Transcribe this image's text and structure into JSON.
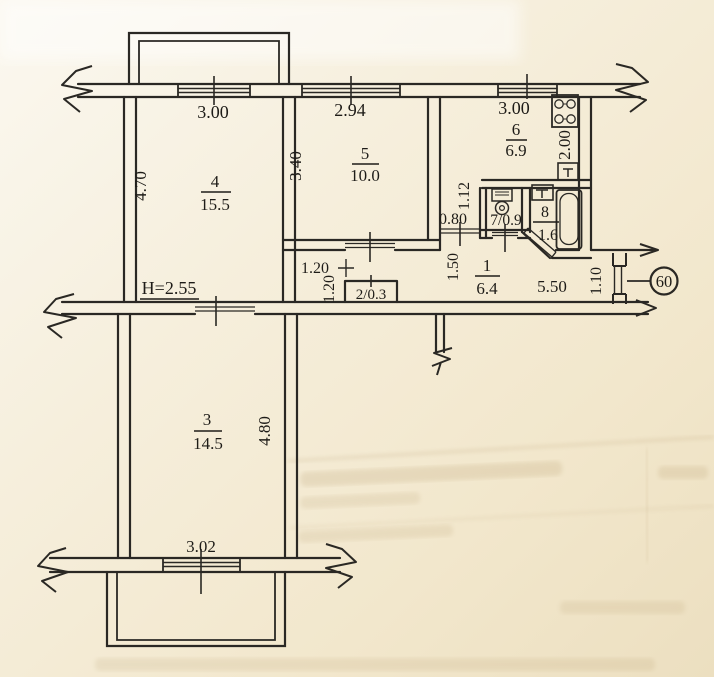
{
  "plan": {
    "height_note": "Н=2.55",
    "apartment_number": "60",
    "rooms": {
      "hall": {
        "number": "1",
        "area": "6.4"
      },
      "closet": {
        "label": "2/0.3"
      },
      "room3": {
        "number": "3",
        "area": "14.5"
      },
      "room4": {
        "number": "4",
        "area": "15.5"
      },
      "room5": {
        "number": "5",
        "area": "10.0"
      },
      "kitchen": {
        "number": "6",
        "area": "6.9"
      },
      "wc": {
        "label": "7/0.9"
      },
      "bath": {
        "number": "8",
        "area": "1.6"
      }
    },
    "dimensions": {
      "window_room4": "3.00",
      "window_room5": "2.94",
      "window_kitchen": "3.00",
      "window_room3": "3.02",
      "room4_depth": "4.70",
      "room5_depth": "3.40",
      "kitchen_depth": "2.00",
      "niche_depth": "1.12",
      "kitchen_door_width": "0.80",
      "hall_width": "1.50",
      "hall_length": "5.50",
      "entry_door_width": "1.10",
      "closet_width": "1.20",
      "closet_depth": "1.20",
      "room3_depth": "4.80"
    },
    "colors": {
      "ink": "#2a2824",
      "paper": "#f5eedb"
    }
  }
}
